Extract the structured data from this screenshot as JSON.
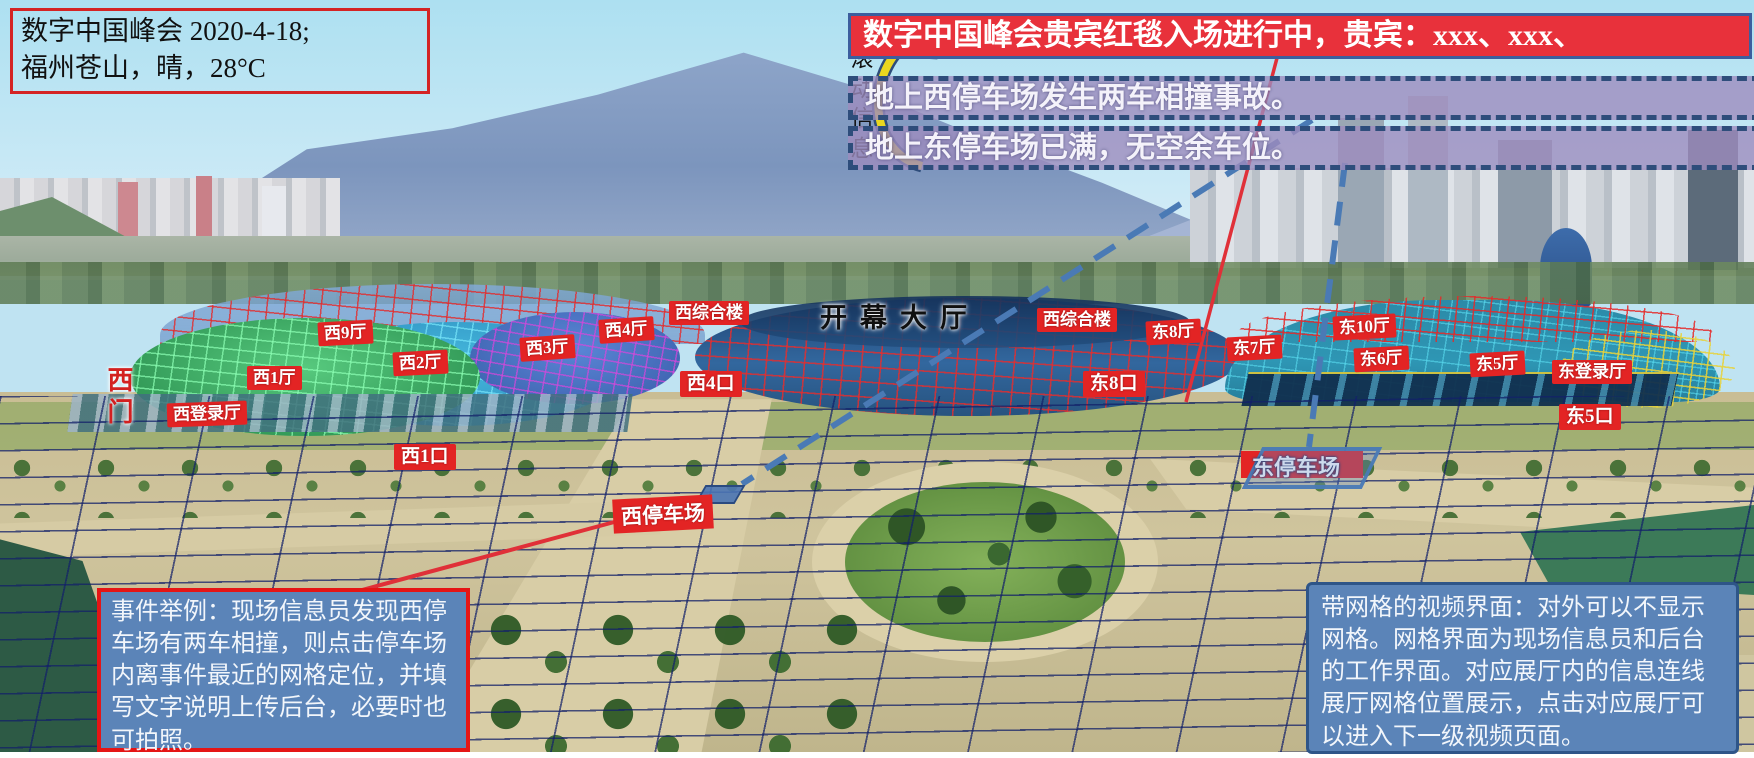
{
  "header": {
    "line1": "数字中国峰会 2020-4-18;",
    "line2": "福州苍山，晴，28°C"
  },
  "ticker": {
    "label": "滚动信息",
    "vip_banner": "数字中国峰会贵宾红毯入场进行中，贵宾：xxx、xxx、",
    "msg_west_parking": "地上西停车场发生两车相撞事故。",
    "msg_east_parking": "地上东停车场已满，无空余车位。"
  },
  "labels": {
    "opening_hall": "开幕大厅",
    "w9": "西9厅",
    "w2": "西2厅",
    "w1": "西1厅",
    "w3": "西3厅",
    "w4": "西4厅",
    "w_login": "西登录厅",
    "w_complex": "西综合楼",
    "west_gate": "西门",
    "gate_w4": "西4口",
    "gate_w1": "西1口",
    "e8": "东8厅",
    "e7": "东7厅",
    "e10": "东10厅",
    "e6": "东6厅",
    "e5": "东5厅",
    "e_login": "东登录厅",
    "gate_e8": "东8口",
    "gate_e5": "东5口",
    "west_parking": "西停车场",
    "east_parking": "东停车场"
  },
  "callouts": {
    "event_example": "事件举例：现场信息员发现西停车场有两车相撞，则点击停车场内离事件最近的网格定位，并填写文字说明上传后台，必要时也可拍照。",
    "grid_note": "带网格的视频界面：对外可以不显示网格。网格界面为现场信息员和后台的工作界面。对应展厅内的信息连线展厅网格位置展示，点击对应展厅可以进入下一级视频页面。"
  },
  "colors": {
    "label_red": "#e32424",
    "banner_red": "#e8313b",
    "callout_blue": "#5b84b8",
    "dashed_border_navy": "#2e4d7b",
    "grid_navy": "#122069",
    "arrow_yellow": "#ead61f",
    "connector_red": "#e03038",
    "connector_blue": "#4a7ab5"
  }
}
